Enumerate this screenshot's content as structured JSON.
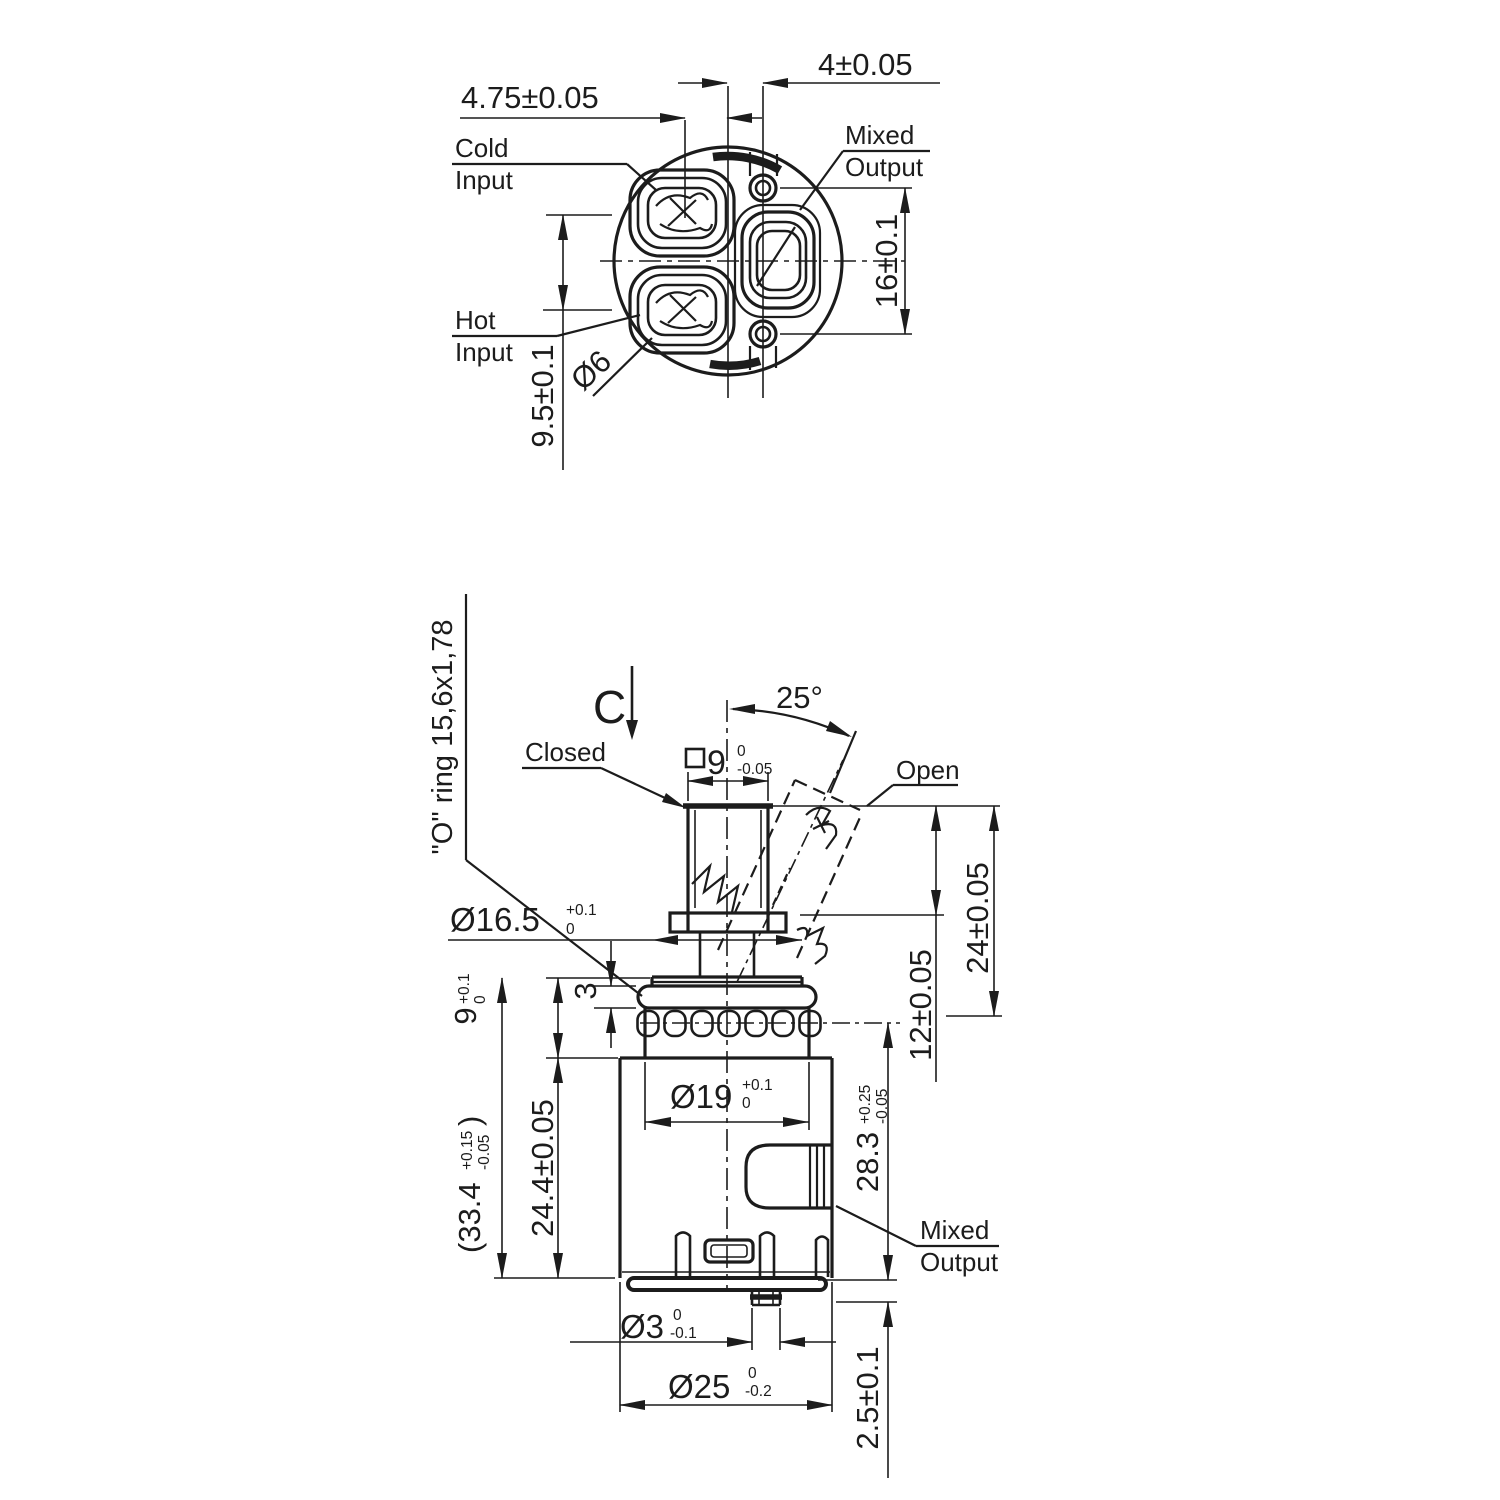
{
  "drawing": {
    "top_view": {
      "labels": {
        "cold_line1": "Cold",
        "cold_line2": "Input",
        "hot_line1": "Hot",
        "hot_line2": "Input",
        "mixed_line1": "Mixed",
        "mixed_line2": "Output"
      },
      "dims": {
        "offset_right": "4±0.05",
        "offset_left": "4.75±0.05",
        "screw_spacing": "16±0.1",
        "port_spacing": "9.5±0.1",
        "hole_dia": "Ø6"
      }
    },
    "side_view": {
      "labels": {
        "section_mark": "C",
        "closed": "Closed",
        "open": "Open",
        "oring": "\"O\" ring 15,6x1,78",
        "mixed_line1": "Mixed",
        "mixed_line2": "Output"
      },
      "dims": {
        "angle": "25°",
        "stem_square": {
          "main": "9",
          "sup": "0",
          "sub": "-0.05"
        },
        "neck": {
          "main": "Ø16.5",
          "sup": "+0.1",
          "sub": "0"
        },
        "collar_h": "3",
        "top_band": {
          "main": "9",
          "sup": "+0.1",
          "sub": "0"
        },
        "total_h": {
          "open": "(33.4",
          "sup": "+0.15",
          "sub": "-0.05",
          "close": ")"
        },
        "body_h": "24.4±0.05",
        "band_dia": {
          "main": "Ø19",
          "sup": "+0.1",
          "sub": "0"
        },
        "outlet_h": {
          "main": "28.3",
          "sup": "+0.25",
          "sub": "-0.05"
        },
        "stem_12": "12±0.05",
        "stem_24": "24±0.05",
        "pin_dia": {
          "main": "Ø3",
          "sup": "0",
          "sub": "-0.1"
        },
        "base_dia": {
          "main": "Ø25",
          "sup": "0",
          "sub": "-0.2"
        },
        "pin_h": "2.5±0.1"
      }
    }
  }
}
